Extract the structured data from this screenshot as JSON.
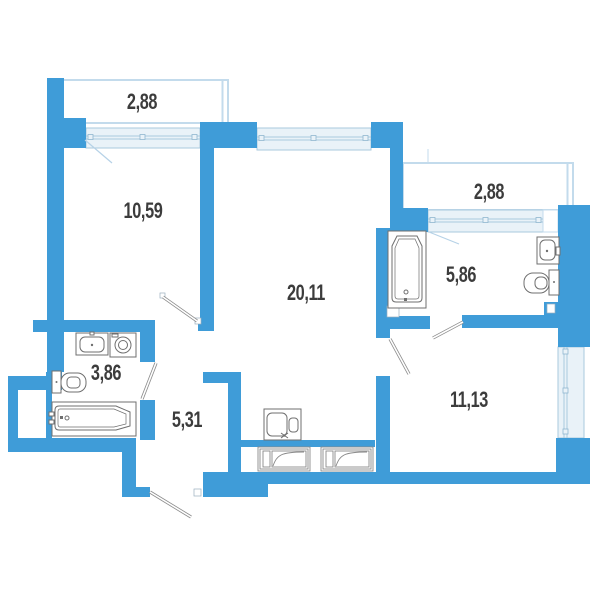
{
  "plan": {
    "labels": {
      "balcony_top": "2,88",
      "bedroom": "10,59",
      "living": "20,11",
      "balcony_right": "2,88",
      "bathroom_right": "5,86",
      "room_right": "11,13",
      "bathroom_left": "3,86",
      "hallway": "5,31"
    },
    "colors": {
      "wall": "#3F9CD8",
      "window_fill": "#E9F2F8",
      "window_line": "#A9C9DE",
      "window_mullion": "#8FB6CF",
      "balcony_outline": "#C3DBEC",
      "door_swing": "#8C8C8C",
      "balcony_door_swing": "#B6D2E7",
      "fixture_outline": "#6F6F6F",
      "label_text": "#3C3C3C",
      "background": "#FFFFFF"
    },
    "fixtures": [
      {
        "name": "sink",
        "room": "bathroom_left"
      },
      {
        "name": "washing-machine",
        "room": "bathroom_left"
      },
      {
        "name": "toilet",
        "room": "bathroom_left"
      },
      {
        "name": "bathtub",
        "room": "bathroom_left"
      },
      {
        "name": "bathtub",
        "room": "bathroom_right"
      },
      {
        "name": "sink",
        "room": "bathroom_right"
      },
      {
        "name": "toilet",
        "room": "bathroom_right"
      },
      {
        "name": "kitchen-sink",
        "room": "living"
      },
      {
        "name": "appliance-symbol",
        "room": "utility-strip"
      },
      {
        "name": "appliance-symbol",
        "room": "utility-strip"
      }
    ]
  }
}
